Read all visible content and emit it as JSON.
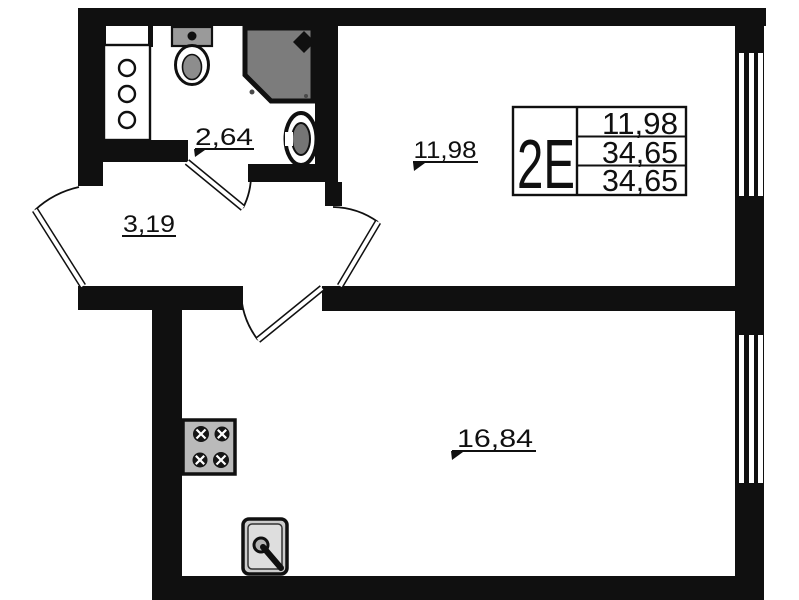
{
  "colors": {
    "wall": "#101010",
    "line": "#101010",
    "white": "#ffffff",
    "shower_fill": "#7c7c7c",
    "stove_fill": "#bababa",
    "tank_fill": "#9a9a9a",
    "bowl_inner": "#8d8d8d",
    "basin_inner": "#757575",
    "sink_fill": "#cccccc",
    "sink_inner": "#dedede",
    "drain_fill": "#b3b3b3"
  },
  "rooms": {
    "bathroom": {
      "area": "2,64"
    },
    "hall": {
      "area": "3,19"
    },
    "room1": {
      "area": "11,98"
    },
    "room2": {
      "area": "16,84"
    }
  },
  "info_table": {
    "type": "2Е",
    "rows": [
      "11,98",
      "34,65",
      "34,65"
    ]
  },
  "fixtures": {
    "shaft": "ventilation-shaft-icon",
    "toilet": "toilet-icon",
    "shower": "shower-cabin-icon",
    "basin": "washbasin-icon",
    "stove": "stove-burners-icon",
    "sink": "kitchen-sink-icon"
  }
}
